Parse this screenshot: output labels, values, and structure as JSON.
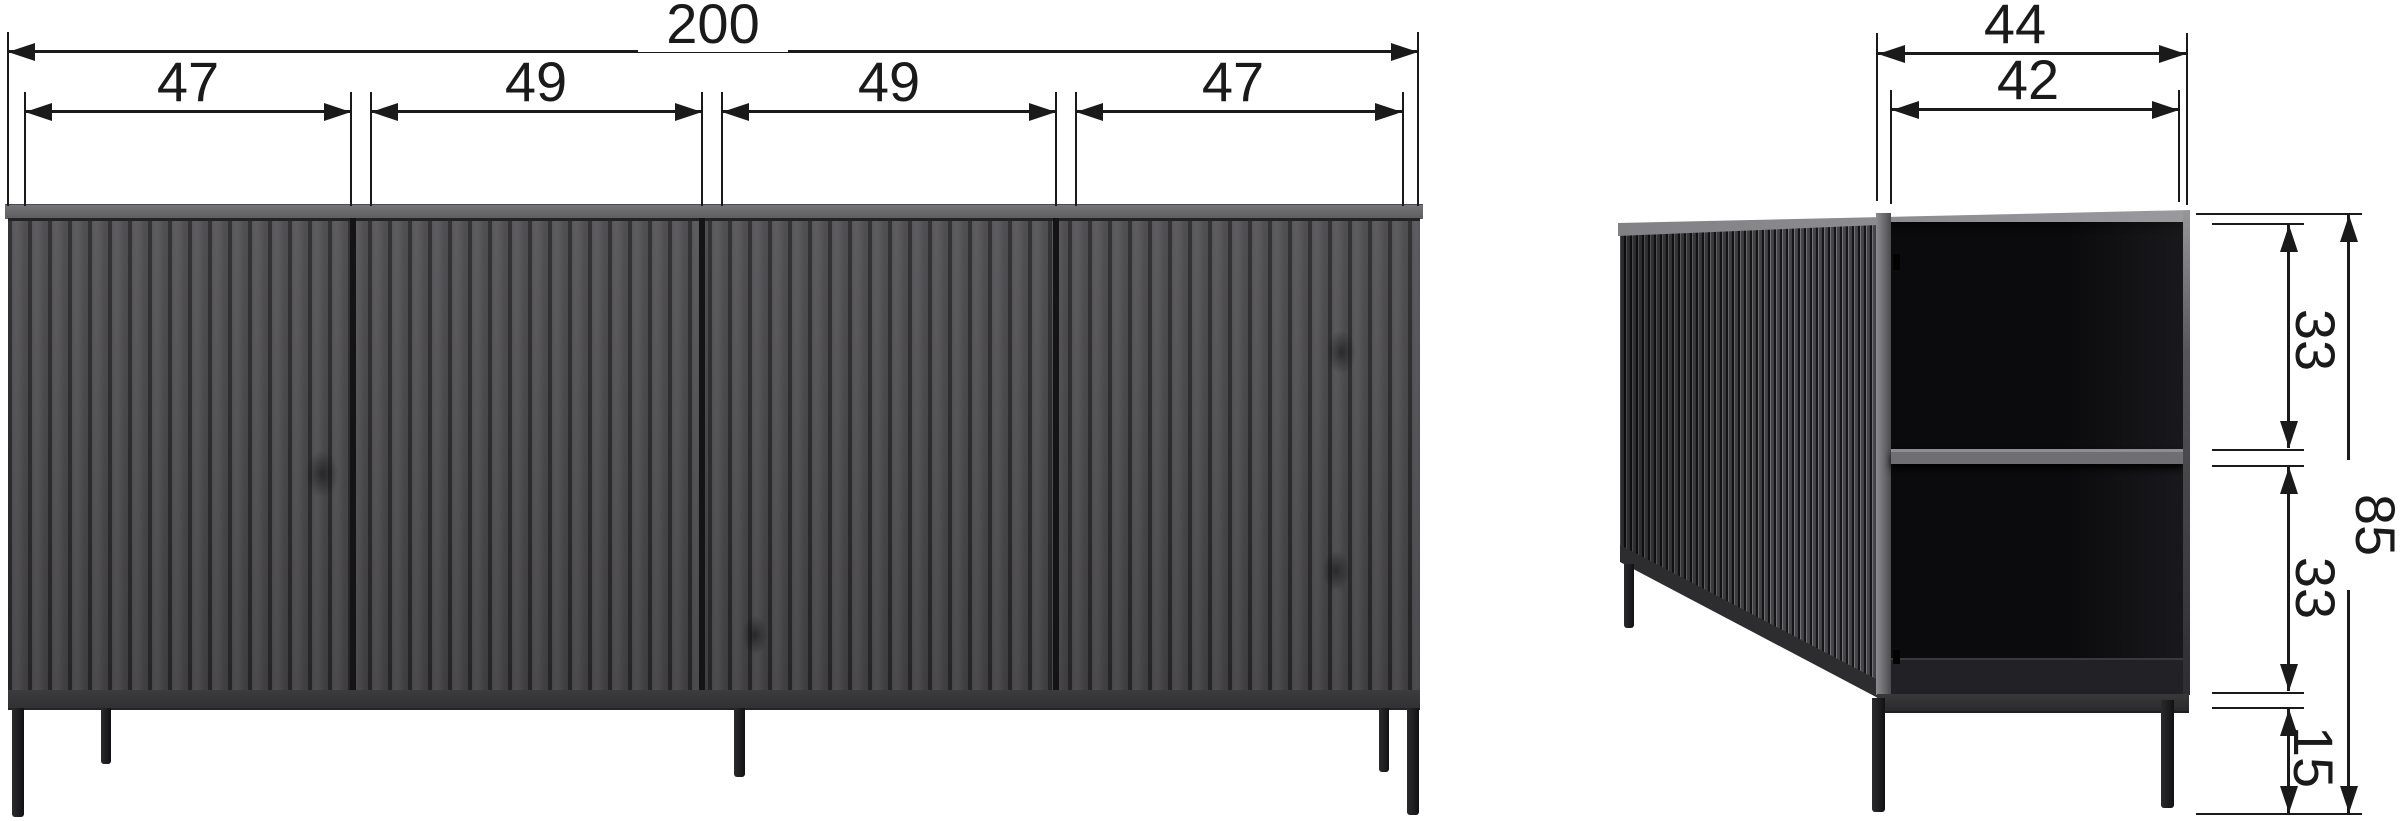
{
  "diagram_title": "sideboard-dimension-drawing",
  "front_view": {
    "overall_width_label": "200",
    "compartment_width_labels": [
      "47",
      "49",
      "49",
      "47"
    ]
  },
  "side_view": {
    "overall_depth_label": "44",
    "inner_depth_label": "42",
    "compartment_height_labels": [
      "33",
      "33"
    ],
    "overall_height_label": "85",
    "leg_height_label": "15"
  },
  "style": {
    "line_color": "#1a1a1a",
    "background": "#ffffff",
    "wood_slat": "#4f4e51",
    "wood_groove": "#29282b",
    "top_surface": "#6a6a6e",
    "interior": "#0b0a0d",
    "shelf_edge": "#6f6f73",
    "leg_color": "#1d1c1f"
  }
}
